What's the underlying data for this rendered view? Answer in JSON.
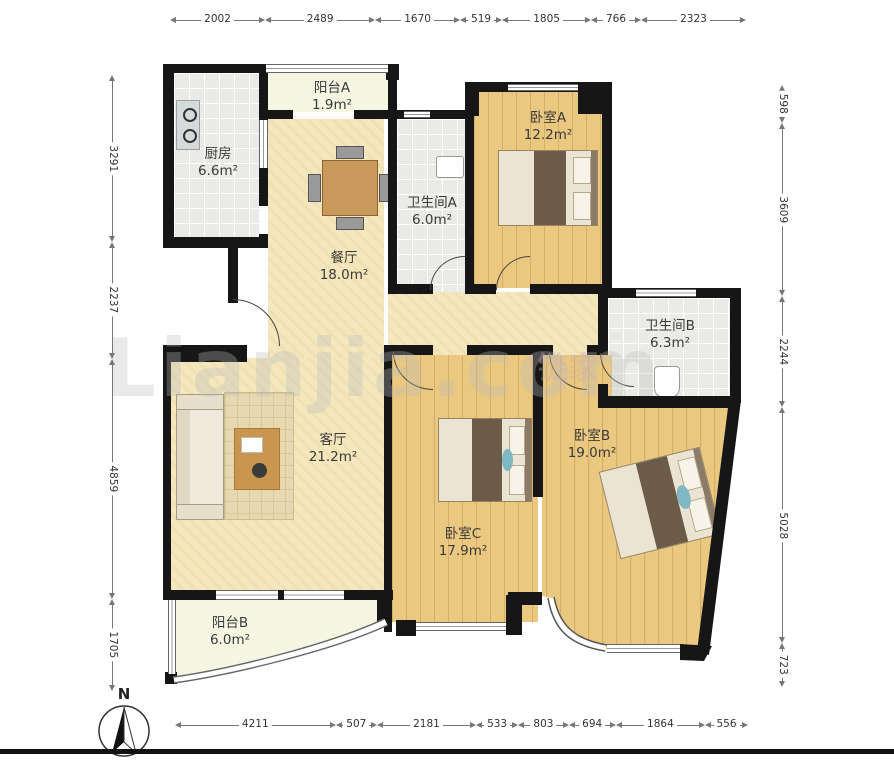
{
  "meta": {
    "watermark": "Lianjia.com",
    "watermark_secondary": "链家",
    "compass_label": "N"
  },
  "rooms": [
    {
      "id": "balcony-a",
      "name": "阳台A",
      "area": "1.9m²"
    },
    {
      "id": "kitchen",
      "name": "厨房",
      "area": "6.6m²"
    },
    {
      "id": "bedroom-a",
      "name": "卧室A",
      "area": "12.2m²"
    },
    {
      "id": "bathroom-a",
      "name": "卫生间A",
      "area": "6.0m²"
    },
    {
      "id": "dining",
      "name": "餐厅",
      "area": "18.0m²"
    },
    {
      "id": "bathroom-b",
      "name": "卫生间B",
      "area": "6.3m²"
    },
    {
      "id": "living",
      "name": "客厅",
      "area": "21.2m²"
    },
    {
      "id": "bedroom-b",
      "name": "卧室B",
      "area": "19.0m²"
    },
    {
      "id": "bedroom-c",
      "name": "卧室C",
      "area": "17.9m²"
    },
    {
      "id": "balcony-b",
      "name": "阳台B",
      "area": "6.0m²"
    }
  ],
  "dimensions": {
    "top": [
      "2002",
      "2489",
      "1670",
      "519",
      "1805",
      "766",
      "2323"
    ],
    "bottom": [
      "4211",
      "507",
      "2181",
      "533",
      "803",
      "694",
      "1864",
      "556"
    ],
    "left": [
      "3291",
      "2237",
      "4859",
      "1705"
    ],
    "right": [
      "598",
      "3609",
      "2244",
      "5028",
      "723"
    ]
  },
  "colors": {
    "wall": "#161616",
    "wood_floor": "#eac87f",
    "pale_floor": "#f4e7bd",
    "tile_floor": "#eaeae6",
    "balcony_floor": "#f6f7e3"
  }
}
